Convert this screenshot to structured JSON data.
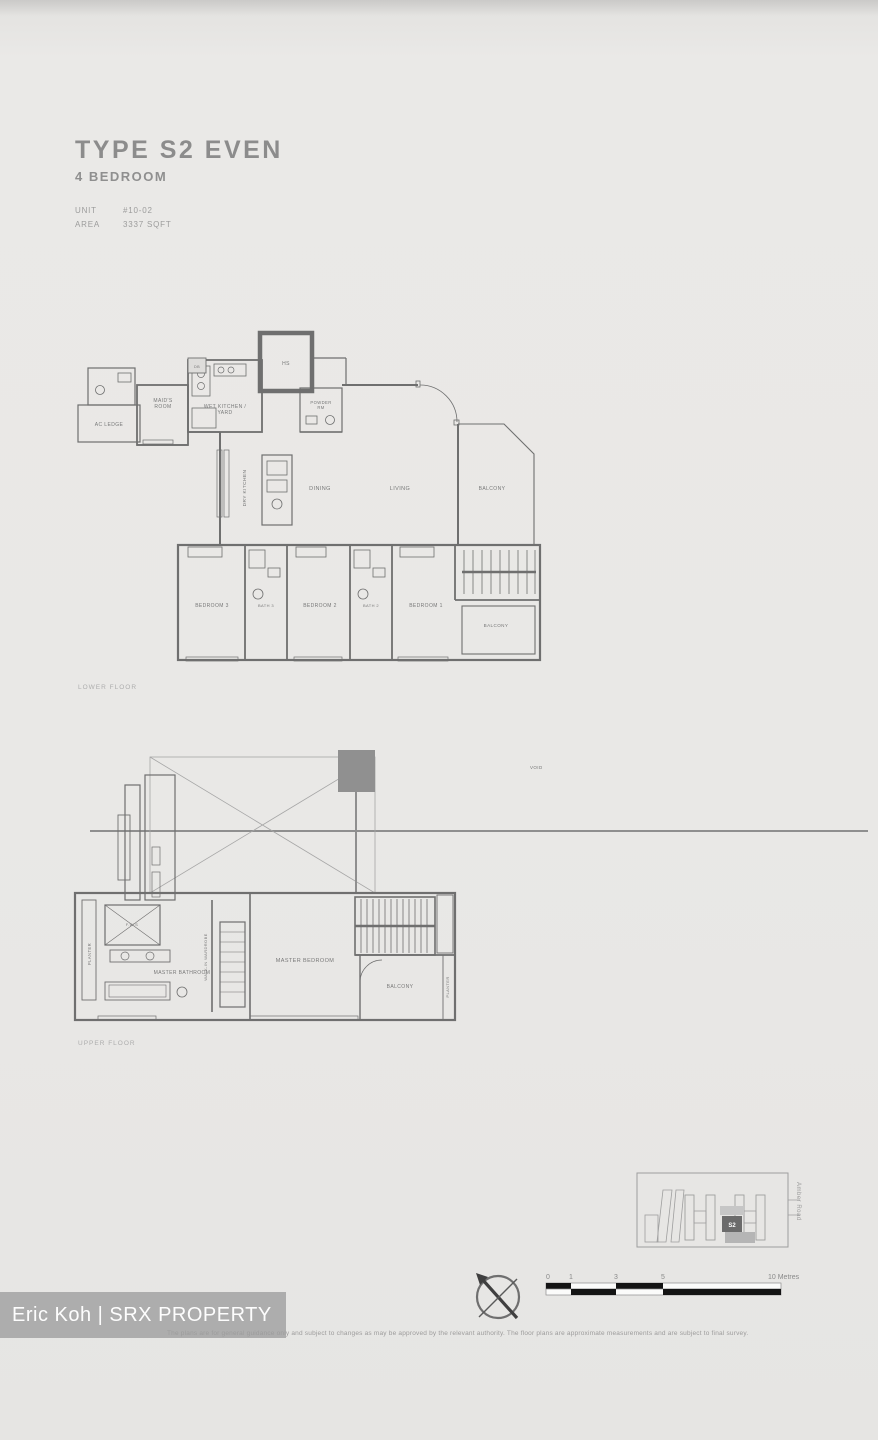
{
  "header": {
    "title": "TYPE S2 EVEN",
    "subtitle": "4 BEDROOM",
    "unit_label": "UNIT",
    "unit_value": "#10-02",
    "area_label": "AREA",
    "area_value": "3337 SQFT"
  },
  "lower_floor": {
    "caption": "LOWER FLOOR",
    "rooms": {
      "ac_ledge": "AC LEDGE",
      "maids_room": "MAID'S\nROOM",
      "db": "DB",
      "wet_kitchen_yard": "WET KITCHEN /\nYARD",
      "hs": "HS",
      "powder_rm": "POWDER\nRM",
      "dry_kitchen": "DRY KITCHEN",
      "dining": "DINING",
      "living": "LIVING",
      "balcony": "BALCONY",
      "bedroom_3": "BEDROOM 3",
      "bath_3": "BATH 3",
      "bedroom_2": "BEDROOM 2",
      "bath_2": "BATH 2",
      "bedroom_1": "BEDROOM 1",
      "balcony_lower": "BALCONY"
    }
  },
  "upper_floor": {
    "caption": "UPPER FLOOR",
    "void_note": "VOID",
    "rooms": {
      "planter_left": "PLANTER",
      "fws": "F.W.S",
      "master_bathroom": "MASTER BATHROOM",
      "walk_in_wardrobe": "WALK-IN WARDROBE",
      "master_bedroom": "MASTER BEDROOM",
      "balcony": "BALCONY",
      "planter_right": "PLANTER"
    }
  },
  "site_plan": {
    "unit_marker": "S2",
    "road_label": "Amber Road"
  },
  "scale_bar": {
    "ticks": [
      "0",
      "1",
      "3",
      "5"
    ],
    "end_label": "10 Metres"
  },
  "watermark": {
    "text": "Eric Koh | SRX PROPERTY"
  },
  "disclaimer": "The plans are for general guidance only and subject to changes as may be approved by the relevant authority. The floor plans are approximate measurements and are subject to final survey.",
  "colors": {
    "background": "#e9e8e6",
    "line": "#6f6f6f",
    "text_muted": "#8e8e8e",
    "dark_fill": "#8f8f8f",
    "watermark_bg": "#a8a8a8"
  }
}
